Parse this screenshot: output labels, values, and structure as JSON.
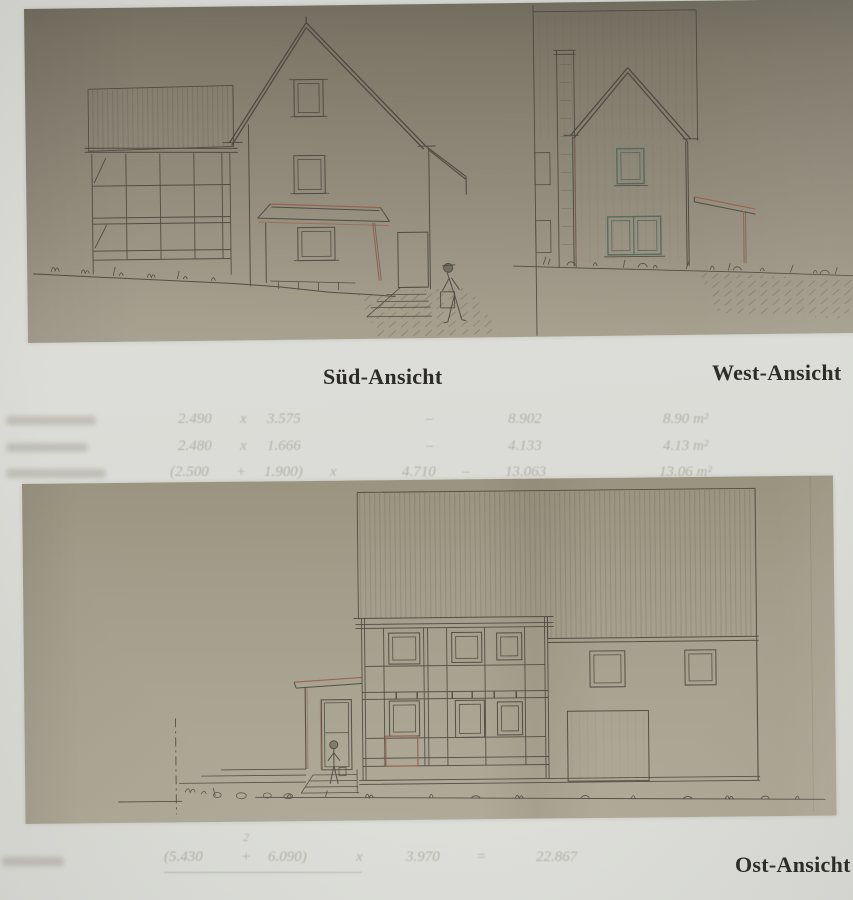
{
  "labels": {
    "south": "Süd-Ansicht",
    "west": "West-Ansicht",
    "east": "Ost-Ansicht"
  },
  "colors": {
    "page_background": "#d9dad5",
    "scan_top_paper": "#8a8475",
    "scan_bottom_paper": "#a9a391",
    "ink": "#45423a",
    "accent_red": "#9b5a49",
    "accent_teal": "#4f6559",
    "caption_text": "#2d2c26",
    "bleedthrough_text": "#8a887a"
  },
  "drawings": {
    "south_elevation": "half-timbered barn wing, gabled house with two stacked windows, porch with hip roof, steps, walking person figure",
    "west_elevation": "gable end with chimney, upper window, double lower window, carport posts, tall barn outline",
    "east_elevation": "large hatched roof, two-storey half-timbered facade with six windows, entry porch with door and person, barn with two windows and garage door"
  },
  "bleed_calculations": {
    "rows": [
      {
        "v1": "2.490",
        "op": "x",
        "v2": "3.575",
        "eq": "–",
        "result": "8.902",
        "area": "8.90 m²"
      },
      {
        "v1": "2.480",
        "op": "x",
        "v2": "1.666",
        "eq": "–",
        "result": "4.133",
        "area": "4.13 m²"
      },
      {
        "v1": "(2.500",
        "op": "+",
        "v2": "1.900)",
        "x2": "x",
        "v3": "4.710",
        "eq": "–",
        "result": "13.063",
        "area": "13.06 m²"
      }
    ],
    "footer": {
      "stray": "2",
      "n1": "(5.430",
      "plus": "+",
      "n2": "6.090)",
      "x": "x",
      "m": "3.970",
      "eq": "=",
      "result": "22.867"
    }
  }
}
